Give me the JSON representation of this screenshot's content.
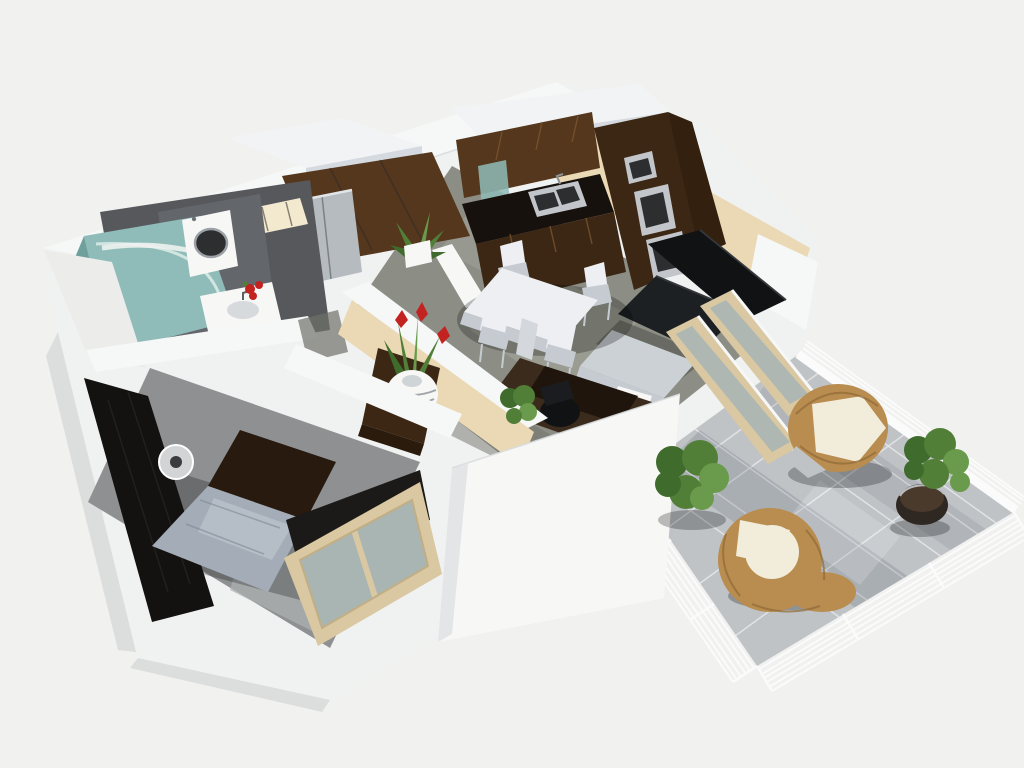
{
  "scene": {
    "title": "3D cutaway floor plan render of a one-bedroom apartment with terrace",
    "description": "Isometric 3D architectural rendering viewed from above: cream cut-away walls with white tops, gray tiled floors, a bathroom with curved glass shower, washing machine and basin with red flowers, an entry hall with silver wardrobe and console vase, a dark-wood kitchen with steel ovens and sink, a white dining set, black leather sofa with coffee table and desk, a bedroom with gray bed and dark wardrobe, and a tiled terrace with white railing, rattan lounge chairs and green shrubs.",
    "rooms": [
      {
        "name": "Bathroom",
        "items": [
          "curved glass corner shower",
          "washing machine",
          "white washbasin with red flowers",
          "mosaic wall strip"
        ]
      },
      {
        "name": "Entry Hall",
        "items": [
          "silver two-door wardrobe",
          "dark wood console table",
          "striped vase with red bromeliad",
          "potted agave"
        ]
      },
      {
        "name": "Kitchen",
        "items": [
          "dark wood upper cabinets",
          "teal glass cabinet door",
          "black countertop with twin steel sink",
          "tall oven column with built-in steel ovens"
        ]
      },
      {
        "name": "Dining Area",
        "items": [
          "white square table",
          "four white chairs"
        ]
      },
      {
        "name": "Living Room",
        "items": [
          "black leather sofa",
          "gray-top coffee table",
          "white sideboard",
          "dark wood desk",
          "black office chair",
          "sliding glass doors to terrace"
        ]
      },
      {
        "name": "Bedroom",
        "items": [
          "double bed with gray duvet",
          "dark wardrobe panel",
          "cylindrical bedside lamp",
          "sliding glass doors"
        ]
      },
      {
        "name": "Terrace",
        "items": [
          "stone tile floor",
          "white bar railing",
          "rattan armchair with cream cushion",
          "rattan lounge chair",
          "green shrub",
          "potted shrub in dark pot"
        ]
      }
    ]
  },
  "palette": {
    "bg": "#f1f1f0",
    "shell": "#f0f1f1",
    "shell_shade": "#dcdedd",
    "slab_top": "#f2f3f4",
    "slab_side": "#d5dae1",
    "band_white": "#f6f7f7",
    "cream_light": "#f3e9cf",
    "cream_mid": "#ead9b4",
    "cream_dark": "#d9c49c",
    "floor_main": "#8c8e85",
    "floor_light": "#a3a59b",
    "floor_dark": "#6f7169",
    "floor_bath": "#56585c",
    "floor_bed": "#8e9092",
    "wood_dark": "#3c2714",
    "wood_mid": "#54371d",
    "wood_seam": "#7a5530",
    "counter_black": "#17110d",
    "steel": "#c2c6ca",
    "steel_dark": "#2c2e30",
    "glass_teal": "#8fbcb8",
    "teal_deep": "#6fa09c",
    "teal_light": "#d8e9e6",
    "white": "#f7f7f6",
    "off_white": "#ececeb",
    "gray_panel": "#63666b",
    "sofa_black": "#101214",
    "sofa_edge": "#1d2022",
    "table_white": "#edeff2",
    "table_shade": "#c6cbd1",
    "duvet": "#a3acb7",
    "duvet_light": "#c2cad2",
    "bed_dark": "#281a0e",
    "frame_tan": "#d9c8a2",
    "frame_tan_dark": "#c2ae84",
    "door_glass": "#a9b5b2",
    "terrace_tile": "#bfc3c6",
    "tile_line": "#e6e8ea",
    "rail_white": "#fbfbfb",
    "wicker": "#b98c50",
    "wicker_dark": "#8f6a35",
    "cushion": "#f2ecdb",
    "green_dark": "#3f6b2c",
    "green_mid": "#517f37",
    "green_light": "#6a9a4c",
    "pot_dark": "#2f2721",
    "soil": "#4a3a2c",
    "flower_red": "#c32320",
    "vase_stripe": "#8a9096",
    "lamp_gray": "#d2d4d6",
    "lamp_dark": "#3a3b3e",
    "silver": "#b6bbc0"
  }
}
